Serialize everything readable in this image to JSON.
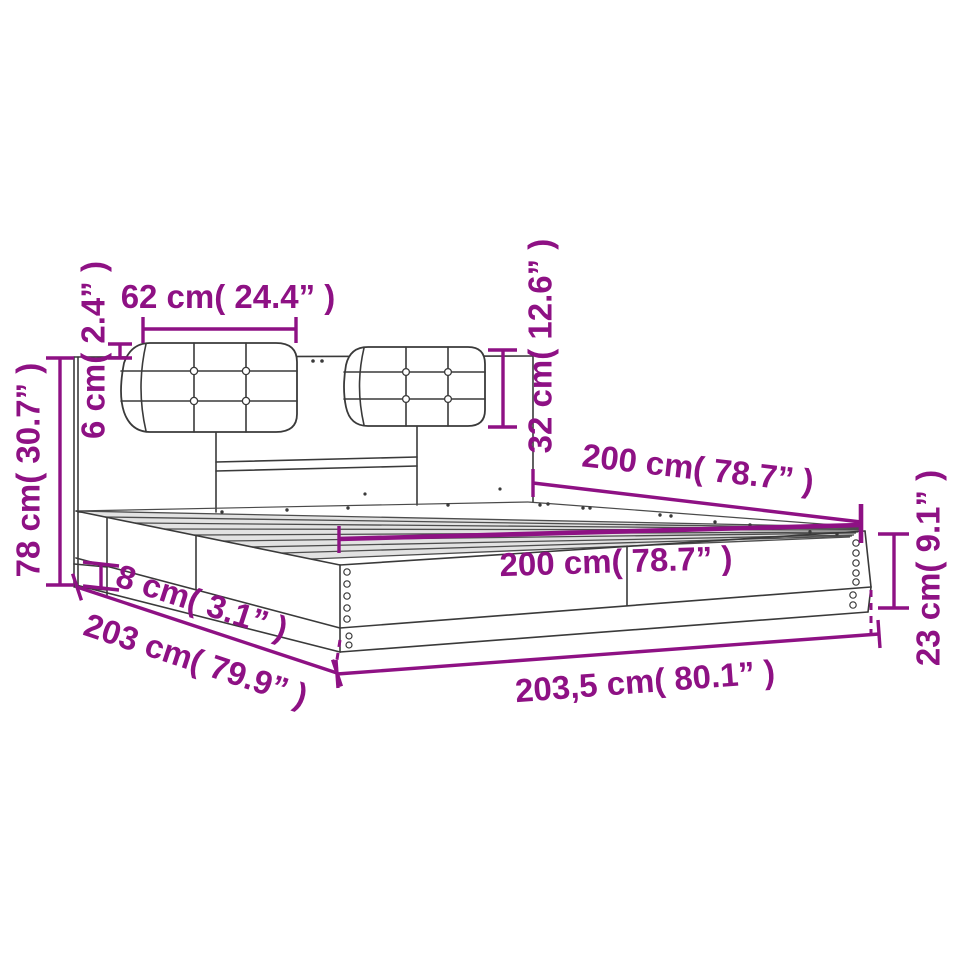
{
  "page": {
    "background": "#ffffff",
    "description": "Bed frame with headboard and two tufted cushions - product dimension diagram"
  },
  "colors": {
    "dimension_annotation": "#8E1184",
    "line_art": "#3a3a3a"
  },
  "units": {
    "primary": "cm",
    "secondary": "inch"
  },
  "dimensions": {
    "cushion_width": {
      "text": "62 cm( 24.4” )",
      "cm": "62",
      "inches": "24.4"
    },
    "headboard_gap": {
      "text": "6 cm( 2.4” )",
      "cm": "6",
      "inches": "2.4"
    },
    "headboard_height": {
      "text": "78 cm( 30.7” )",
      "cm": "78",
      "inches": "30.7"
    },
    "cushion_height": {
      "text": "32 cm( 12.6” )",
      "cm": "32",
      "inches": "12.6"
    },
    "inner_length_upper": {
      "text": "200 cm( 78.7” )",
      "cm": "200",
      "inches": "78.7"
    },
    "inner_length_lower": {
      "text": "200 cm( 78.7” )",
      "cm": "200",
      "inches": "78.7"
    },
    "frame_height": {
      "text": "23 cm( 9.1” )",
      "cm": "23",
      "inches": "9.1"
    },
    "total_length": {
      "text": "203,5 cm( 80.1” )",
      "cm": "203,5",
      "inches": "80.1"
    },
    "total_width": {
      "text": "203 cm( 79.9” )",
      "cm": "203",
      "inches": "79.9"
    },
    "rail_height": {
      "text": "8 cm( 3.1” )",
      "cm": "8",
      "inches": "3.1"
    }
  }
}
